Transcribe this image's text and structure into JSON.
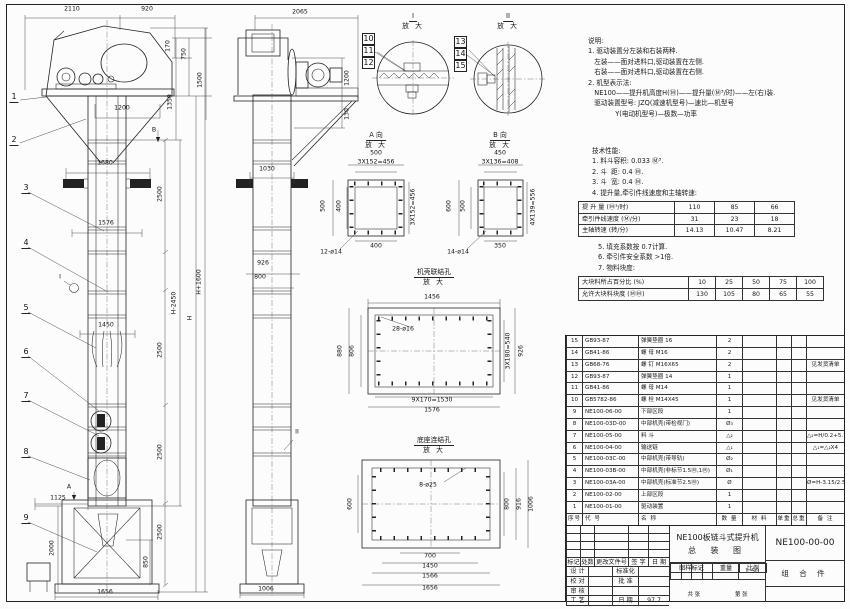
{
  "notes": {
    "lines": [
      "说明:",
      "1. 驱动装置分左装和右装两种.",
      "   左装——面对进料口,驱动装置在左侧.",
      "   右装——面对进料口,驱动装置在右侧.",
      "2. 机型表示法:",
      "   NE100——提升机高度H(Ⓜ)——提升量(Ⓜ³/时)——左(右)装.",
      "   驱动装置型号: JZQ(减速机型号)—速比—机型号",
      "             Y(电动机型号)—极数—功率"
    ]
  },
  "tech": {
    "lines": [
      "技术性能:",
      "1. 料斗容积: 0.033 Ⓜ³.",
      "2. 斗  距: 0.4 Ⓜ.",
      "3. 斗  宽: 0.4 Ⓜ.",
      "4. 提升量,牵引件线速度和主轴转速:"
    ],
    "table1": [
      [
        "提 升 量  (Ⓜ³/时)",
        "110",
        "85",
        "66"
      ],
      [
        "牵引件线速度 (Ⓜ/分)",
        "31",
        "23",
        "18"
      ],
      [
        "主轴转速  (转/分)",
        "14.13",
        "10.47",
        "8.21"
      ]
    ],
    "after": [
      "5. 填充系数按 0.7计算.",
      "6. 牵引件安全系数 >1倍.",
      "7. 物料块度:"
    ],
    "table2": [
      [
        "大块料所占百分比 (%)",
        "10",
        "25",
        "50",
        "75",
        "100"
      ],
      [
        "允许大块料块度 (ⓂⓂ)",
        "130",
        "105",
        "80",
        "65",
        "55"
      ]
    ]
  },
  "bom": {
    "headers": [
      "序号",
      "代  号",
      "名  称",
      "数 量",
      "材  料",
      "单重",
      "总重",
      "备 注"
    ],
    "rows": [
      [
        "15",
        "GB93-87",
        "弹簧垫圈 16",
        "2",
        "",
        "",
        "",
        ""
      ],
      [
        "14",
        "GB41-86",
        "螺 母 M16",
        "2",
        "",
        "",
        "",
        ""
      ],
      [
        "13",
        "GB68-76",
        "螺 钉 M16X65",
        "2",
        "",
        "",
        "",
        "见发货清单"
      ],
      [
        "12",
        "GB93-87",
        "弹簧垫圈 14",
        "1",
        "",
        "",
        "",
        ""
      ],
      [
        "11",
        "GB41-86",
        "螺 母 M14",
        "1",
        "",
        "",
        "",
        ""
      ],
      [
        "10",
        "GB5782-86",
        "螺 栓 M14X45",
        "1",
        "",
        "",
        "",
        "见发货清单"
      ],
      [
        "9",
        "NE100-06-00",
        "下部区段",
        "1",
        "",
        "",
        "",
        ""
      ],
      [
        "8",
        "NE100-03D-00",
        "中部机壳(带检视门)",
        "Ø₃",
        "",
        "",
        "",
        ""
      ],
      [
        "7",
        "NE100-05-00",
        "料 斗",
        "△₂",
        "",
        "",
        "",
        "△₂=H/0.2+5.75"
      ],
      [
        "6",
        "NE100-04-00",
        "输送链",
        "△₁",
        "",
        "",
        "",
        "△₁=△₂X4"
      ],
      [
        "5",
        "NE100-03C-00",
        "中部机壳(带导轨)",
        "Ø₂",
        "",
        "",
        "",
        ""
      ],
      [
        "4",
        "NE100-03B-00",
        "中部机壳(非标节1.5Ⓜ,1Ⓜ)",
        "Ø₁",
        "",
        "",
        "",
        ""
      ],
      [
        "3",
        "NE100-03A-00",
        "中部机壳(标准节2.5Ⓜ)",
        "Ø",
        "",
        "",
        "",
        "Ø=H-3.15/2.5"
      ],
      [
        "2",
        "NE100-02-00",
        "上部区段",
        "1",
        "",
        "",
        "",
        ""
      ],
      [
        "1",
        "NE100-01-00",
        "驱动装置",
        "1",
        "",
        "",
        "",
        ""
      ]
    ]
  },
  "title_block": {
    "product": "NE100板链斗式提升机",
    "drawing_type": "总 装 图",
    "drawing_no": "NE100-00-00",
    "part_class": "组 合 件",
    "rev_empty": [
      [
        "",
        "",
        "",
        "",
        ""
      ],
      [
        "",
        "",
        "",
        "",
        ""
      ],
      [
        "",
        "",
        "",
        "",
        ""
      ],
      [
        "",
        "",
        "",
        "",
        ""
      ]
    ],
    "rev_head": [
      [
        "标记",
        "处数",
        "更改文件号",
        "签 字",
        "日 期"
      ]
    ],
    "roles_rows": [
      [
        "设 计",
        "",
        "标准化",
        ""
      ],
      [
        "校 对",
        "",
        "批 准",
        ""
      ],
      [
        "审 核",
        "",
        "",
        ""
      ],
      [
        "工 艺",
        "",
        "日 期",
        "97.7"
      ]
    ],
    "stamp_head": [
      [
        "图样标记",
        "重量",
        "比例"
      ]
    ],
    "scale": "1:50",
    "sheet_total": "共  张",
    "sheet_no": "第  张"
  },
  "details": {
    "d1": {
      "label": "I",
      "sub": "放 大"
    },
    "d2": {
      "label": "II",
      "sub": "放 大"
    },
    "va": {
      "label": "A 向",
      "sub": "放 大"
    },
    "vb": {
      "label": "B 向",
      "sub": "放 大"
    },
    "shell": {
      "label": "机壳联结孔",
      "sub": "放 大"
    },
    "base": {
      "label": "底座连结孔",
      "sub": "放 大"
    }
  },
  "drawing": {
    "dim_labels": [
      {
        "t": "2110",
        "x": 72,
        "y": 9
      },
      {
        "t": "920",
        "x": 147,
        "y": 9
      },
      {
        "t": "170",
        "x": 168,
        "y": 46,
        "r": 1
      },
      {
        "t": "750",
        "x": 184,
        "y": 54,
        "r": 1
      },
      {
        "t": "1350",
        "x": 170,
        "y": 102,
        "r": 1
      },
      {
        "t": "1500",
        "x": 200,
        "y": 80,
        "r": 1
      },
      {
        "t": "1200",
        "x": 122,
        "y": 108
      },
      {
        "t": "B",
        "x": 154,
        "y": 130
      },
      {
        "t": "1680",
        "x": 105,
        "y": 163
      },
      {
        "t": "2500",
        "x": 160,
        "y": 194,
        "r": 1
      },
      {
        "t": "1576",
        "x": 106,
        "y": 223
      },
      {
        "t": "H+1600",
        "x": 199,
        "y": 282,
        "r": 1
      },
      {
        "t": "H-2450",
        "x": 174,
        "y": 303,
        "r": 1
      },
      {
        "t": "H",
        "x": 190,
        "y": 318,
        "r": 1
      },
      {
        "t": "1450",
        "x": 106,
        "y": 325
      },
      {
        "t": "2500",
        "x": 160,
        "y": 350,
        "r": 1
      },
      {
        "t": "2500",
        "x": 160,
        "y": 452,
        "r": 1
      },
      {
        "t": "2500",
        "x": 160,
        "y": 532,
        "r": 1
      },
      {
        "t": "850",
        "x": 146,
        "y": 562,
        "r": 1
      },
      {
        "t": "1125",
        "x": 58,
        "y": 498
      },
      {
        "t": "2000",
        "x": 52,
        "y": 548,
        "r": 1
      },
      {
        "t": "1656",
        "x": 105,
        "y": 592
      },
      {
        "t": "A",
        "x": 69,
        "y": 487
      },
      {
        "t": "I",
        "x": 60,
        "y": 277
      },
      {
        "t": "2065",
        "x": 300,
        "y": 12
      },
      {
        "t": "1200",
        "x": 347,
        "y": 78,
        "r": 1
      },
      {
        "t": "130",
        "x": 347,
        "y": 114,
        "r": 1
      },
      {
        "t": "1030",
        "x": 267,
        "y": 169
      },
      {
        "t": "926",
        "x": 263,
        "y": 263
      },
      {
        "t": "800",
        "x": 260,
        "y": 277
      },
      {
        "t": "1006",
        "x": 266,
        "y": 589
      },
      {
        "t": "II",
        "x": 297,
        "y": 432
      },
      {
        "t": "500",
        "x": 376,
        "y": 153
      },
      {
        "t": "3X152=456",
        "x": 376,
        "y": 162
      },
      {
        "t": "500",
        "x": 323,
        "y": 206,
        "r": 1
      },
      {
        "t": "400",
        "x": 339,
        "y": 206,
        "r": 1
      },
      {
        "t": "3X152=456",
        "x": 413,
        "y": 207,
        "r": 1
      },
      {
        "t": "400",
        "x": 376,
        "y": 246
      },
      {
        "t": "12-ø14",
        "x": 331,
        "y": 252
      },
      {
        "t": "450",
        "x": 500,
        "y": 153
      },
      {
        "t": "3X136=408",
        "x": 500,
        "y": 162
      },
      {
        "t": "600",
        "x": 449,
        "y": 206,
        "r": 1
      },
      {
        "t": "500",
        "x": 463,
        "y": 206,
        "r": 1
      },
      {
        "t": "4X139=556",
        "x": 533,
        "y": 207,
        "r": 1
      },
      {
        "t": "350",
        "x": 500,
        "y": 246
      },
      {
        "t": "14-ø14",
        "x": 458,
        "y": 252
      },
      {
        "t": "1456",
        "x": 432,
        "y": 297
      },
      {
        "t": "28-ø16",
        "x": 403,
        "y": 329
      },
      {
        "t": "880",
        "x": 340,
        "y": 351,
        "r": 1
      },
      {
        "t": "806",
        "x": 352,
        "y": 351,
        "r": 1
      },
      {
        "t": "3X180=540",
        "x": 508,
        "y": 351,
        "r": 1
      },
      {
        "t": "926",
        "x": 521,
        "y": 351,
        "r": 1
      },
      {
        "t": "9X170=1530",
        "x": 432,
        "y": 400
      },
      {
        "t": "1576",
        "x": 432,
        "y": 410
      },
      {
        "t": "8-ø25",
        "x": 428,
        "y": 485
      },
      {
        "t": "600",
        "x": 350,
        "y": 504,
        "r": 1
      },
      {
        "t": "800",
        "x": 507,
        "y": 504,
        "r": 1
      },
      {
        "t": "916",
        "x": 519,
        "y": 504,
        "r": 1
      },
      {
        "t": "1006",
        "x": 531,
        "y": 504,
        "r": 1
      },
      {
        "t": "700",
        "x": 430,
        "y": 556
      },
      {
        "t": "1450",
        "x": 430,
        "y": 566
      },
      {
        "t": "1566",
        "x": 430,
        "y": 576
      },
      {
        "t": "1656",
        "x": 430,
        "y": 588
      }
    ],
    "balloons": [
      {
        "n": "1",
        "x": 14,
        "y": 103
      },
      {
        "n": "2",
        "x": 14,
        "y": 146
      },
      {
        "n": "3",
        "x": 26,
        "y": 194
      },
      {
        "n": "4",
        "x": 26,
        "y": 249
      },
      {
        "n": "5",
        "x": 26,
        "y": 314
      },
      {
        "n": "6",
        "x": 26,
        "y": 358
      },
      {
        "n": "7",
        "x": 26,
        "y": 402
      },
      {
        "n": "8",
        "x": 26,
        "y": 458
      },
      {
        "n": "9",
        "x": 26,
        "y": 524
      },
      {
        "n": "10",
        "x": 362,
        "y": 33,
        "boxed": 1
      },
      {
        "n": "11",
        "x": 362,
        "y": 45,
        "boxed": 1
      },
      {
        "n": "12",
        "x": 362,
        "y": 57,
        "boxed": 1
      },
      {
        "n": "13",
        "x": 454,
        "y": 36,
        "boxed": 1
      },
      {
        "n": "14",
        "x": 454,
        "y": 48,
        "boxed": 1
      },
      {
        "n": "15",
        "x": 454,
        "y": 60,
        "boxed": 1
      }
    ]
  }
}
